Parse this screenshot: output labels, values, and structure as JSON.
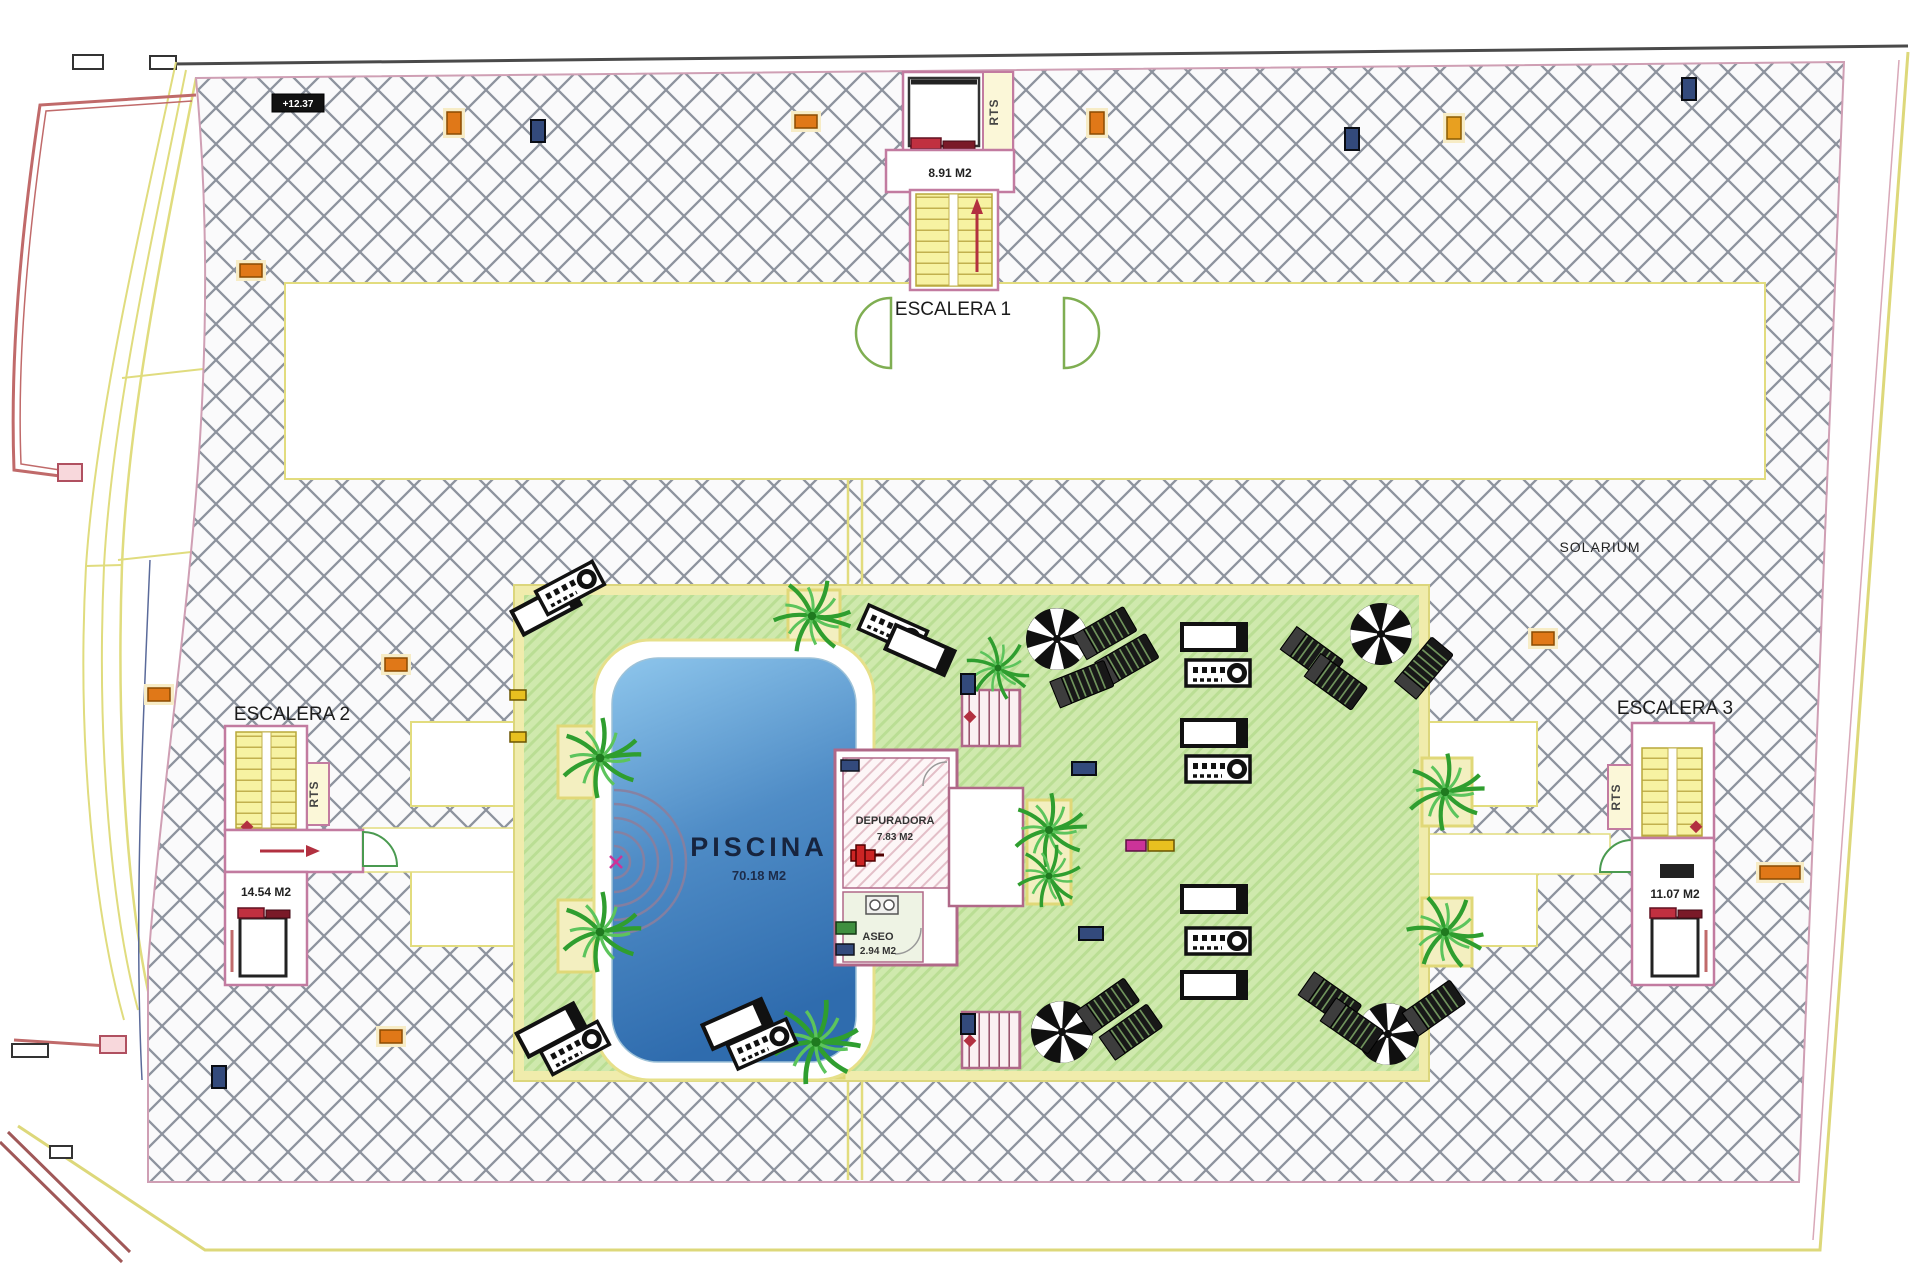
{
  "labels": {
    "escalera1": "ESCALERA 1",
    "escalera2": "ESCALERA 2",
    "escalera3": "ESCALERA 3",
    "escalera1_area": "8.91 M2",
    "escalera2_area": "14.54 M2",
    "escalera3_area": "11.07 M2",
    "rts": "RTS",
    "solarium": "SOLARIUM",
    "piscina": "PISCINA",
    "piscina_area": "70.18 M2",
    "depuradora": "DEPURADORA",
    "depuradora_area": "7.83 M2",
    "aseo": "ASEO",
    "aseo_area": "2.94 M2",
    "level_marker": "+12.37"
  },
  "colors": {
    "deck_hatch_line": "#8d939e",
    "green_zone": "#cfe9ad",
    "pool_light": "#8ec6ec",
    "pool_dark": "#2f6cae",
    "wall_pink": "#b06888",
    "stair_yellow": "#f7f2a2",
    "boundary_yellow": "#ddd87a",
    "marker_orange": "#e07818",
    "marker_blue": "#334a7c",
    "door_green": "#4a9a50",
    "accent_red": "#b23040"
  }
}
